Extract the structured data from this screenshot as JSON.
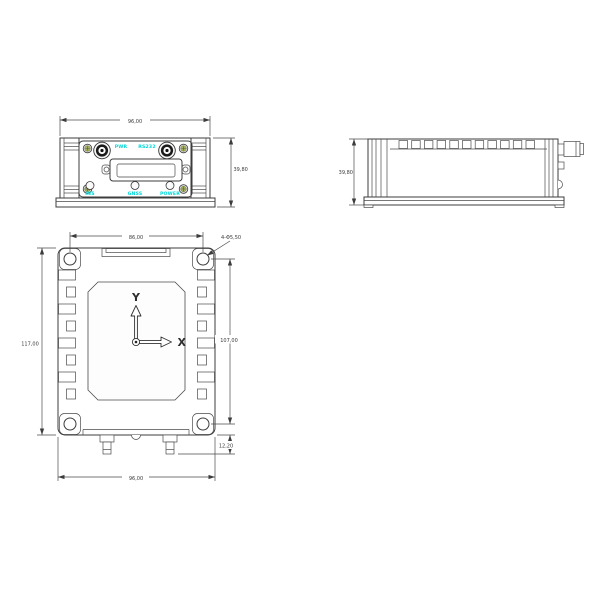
{
  "front_view": {
    "dim_width": "96,00",
    "dim_height": "39,80",
    "labels": {
      "pwr": "PWR",
      "rs232": "RS232",
      "ins": "INS",
      "gnss": "GNSS",
      "power": "POWER"
    }
  },
  "side_view": {
    "dim_height": "39,80"
  },
  "top_view": {
    "dim_hole_spacing_x": "86,00",
    "hole_callout": "4-Φ5,50",
    "dim_overall_height": "117,00",
    "dim_hole_spacing_y": "107,00",
    "dim_connector_offset": "12,20",
    "dim_overall_width": "96,00",
    "axes": {
      "x": "X",
      "y": "Y"
    }
  },
  "colors": {
    "line": "#3f3f3f",
    "silkscreen_label": "#00d8d8",
    "screw_head": "#a9b25f"
  }
}
